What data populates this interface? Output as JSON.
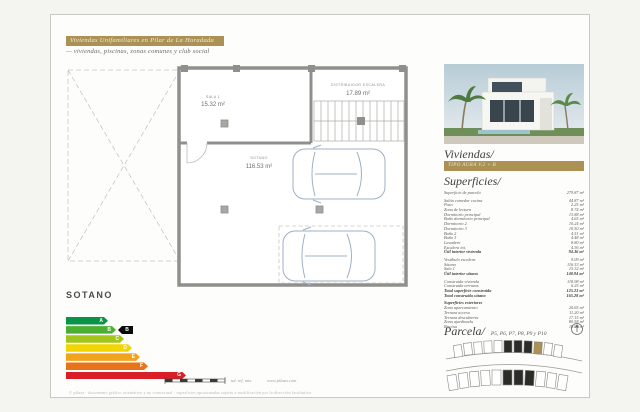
{
  "header": {
    "banner": "Viviendas Unifamiliares en Pilar de La Horadada",
    "subtitle": "— viviendas, piscinas, zonas comunes y club social"
  },
  "plan": {
    "floor_label": "SOTANO",
    "rooms": [
      {
        "name": "SALA 1",
        "area": "15.32 m²"
      },
      {
        "name": "DISTRIBUIDOR ESCALERA",
        "area": "17.89 m²"
      },
      {
        "name": "SOTANO",
        "area": "116.53 m²"
      }
    ]
  },
  "energy_label": {
    "rating_letter": "B",
    "marker_color": "#0a0a0a",
    "bars": [
      {
        "letter": "A",
        "color": "#0a9447"
      },
      {
        "letter": "B",
        "color": "#4cae31"
      },
      {
        "letter": "C",
        "color": "#a2c51c"
      },
      {
        "letter": "D",
        "color": "#f2d500"
      },
      {
        "letter": "E",
        "color": "#f0a31d"
      },
      {
        "letter": "F",
        "color": "#e8731a"
      },
      {
        "letter": "G",
        "color": "#d81e26"
      }
    ]
  },
  "scale_bar": {
    "caption": "ud. ref. mts.",
    "website": "www.pilaza.com"
  },
  "footer": {
    "disclaimer": "© pilaza · documento gráfico orientativo y no contractual · superficies aproximadas sujetas a modificación por la dirección facultativa"
  },
  "panel": {
    "title": "Viviendas/",
    "type_banner": "TIPO AURA V.2 + B",
    "superficies_title": "Superficies/",
    "parcela_title": "Parcela/",
    "parcela_subtitle": "P5, P6, P7, P8, P9 y P10",
    "superficies": {
      "rows": [
        {
          "label": "Superficie de parcela",
          "value": "279.87 m²"
        },
        {
          "label": "Salón comedor cocina",
          "value": "44.87 m²",
          "gap": true
        },
        {
          "label": "Paso",
          "value": "2.25 m²"
        },
        {
          "label": "Zona de lectura",
          "value": "8.74 m²"
        },
        {
          "label": "Dormitorio principal",
          "value": "13.88 m²"
        },
        {
          "label": "Baño dormitorio principal",
          "value": "4.65 m²"
        },
        {
          "label": "Dormitorio 2",
          "value": "10.24 m²"
        },
        {
          "label": "Dormitorio 3",
          "value": "10.50 m²"
        },
        {
          "label": "Baño 2",
          "value": "4.51 m²"
        },
        {
          "label": "Baño 3",
          "value": "4.48 m²"
        },
        {
          "label": "Lavadero",
          "value": "8.80 m²"
        },
        {
          "label": "Escalera int.",
          "value": "4.36 m²"
        },
        {
          "label": "Útil interior vivienda",
          "value": "94.36 m²",
          "bold": true
        },
        {
          "label": "Vestíbulo escalera",
          "value": "9.09 m²",
          "gap": true
        },
        {
          "label": "Sótano",
          "value": "116.53 m²"
        },
        {
          "label": "Sala 1",
          "value": "15.32 m²"
        },
        {
          "label": "Útil interior sótano",
          "value": "140.94 m²",
          "bold": true
        },
        {
          "label": "Construida vivienda",
          "value": "118.98 m²",
          "gap": true
        },
        {
          "label": "Construida terrazas",
          "value": "6.25 m²"
        },
        {
          "label": "Total superficie construida",
          "value": "125.23 m²",
          "bold": true
        },
        {
          "label": "Total construida sótano",
          "value": "165.28 m²",
          "bold": true
        },
        {
          "label": "Superficies exteriores",
          "value": "",
          "bold": true,
          "gap": true
        },
        {
          "label": "Zona aparcamiento",
          "value": "20.65 m²"
        },
        {
          "label": "Terraza acceso",
          "value": "11.20 m²"
        },
        {
          "label": "Terraza descubierta",
          "value": "17.15 m²"
        },
        {
          "label": "Zona ajardinada",
          "value": "80.58 m²"
        },
        {
          "label": "Piscina",
          "value": "18.80 m²"
        }
      ]
    }
  },
  "colors": {
    "gold": "#ab9254",
    "wall_gray": "#8f8f8b",
    "car_blue": "#9db0c4"
  }
}
